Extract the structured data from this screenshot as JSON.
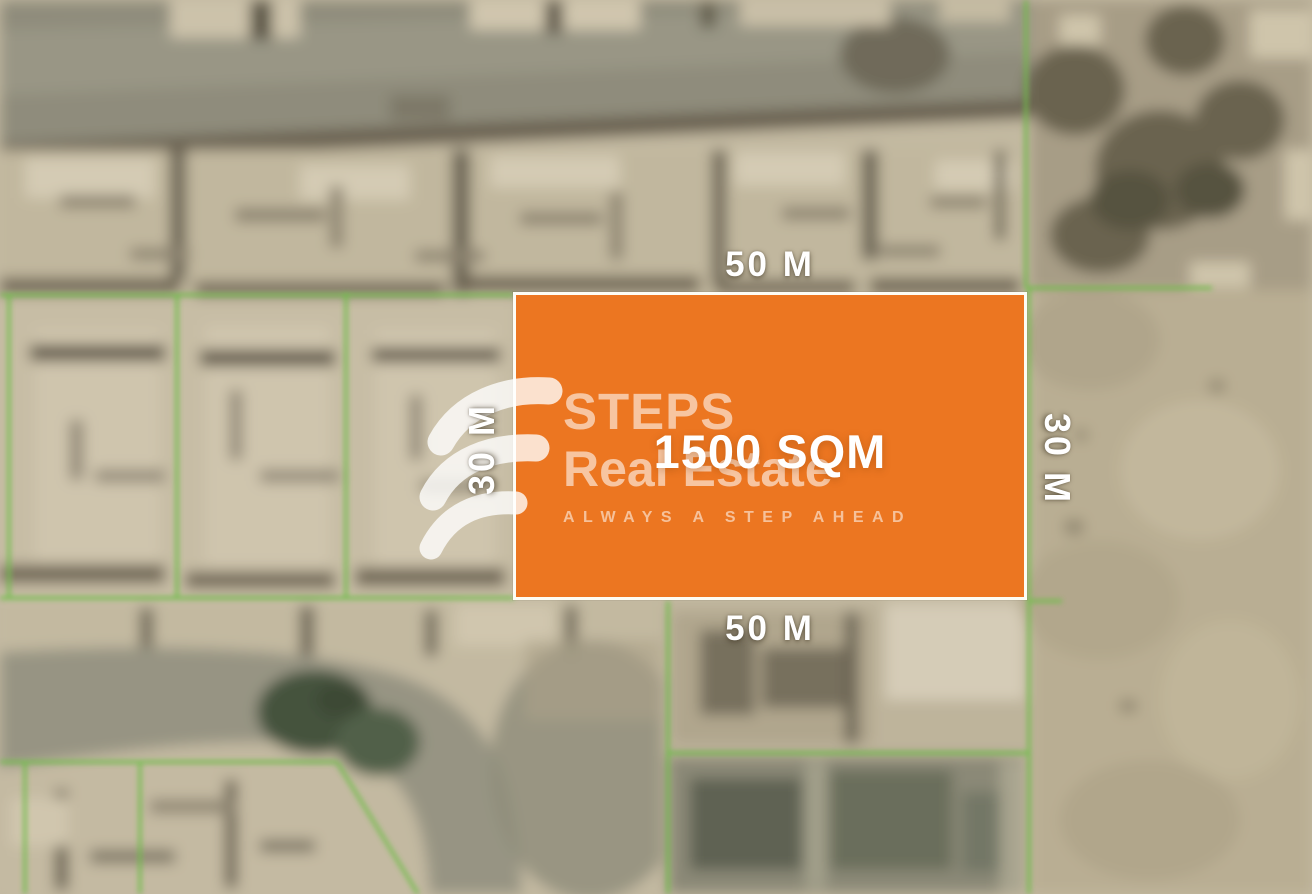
{
  "map_overlay": {
    "area": "1500 SQM",
    "dim_top": "50 M",
    "dim_bottom": "50 M",
    "dim_left": "30 M",
    "dim_right": "30 M",
    "plot_color": "#EC7621",
    "plot_border_color": "#FDFCF4",
    "boundary_line_color": "#6FBE49"
  },
  "watermark": {
    "brand_line1": "STEPS",
    "brand_line2": "Real Estate",
    "tagline": "ALWAYS A STEP AHEAD"
  }
}
